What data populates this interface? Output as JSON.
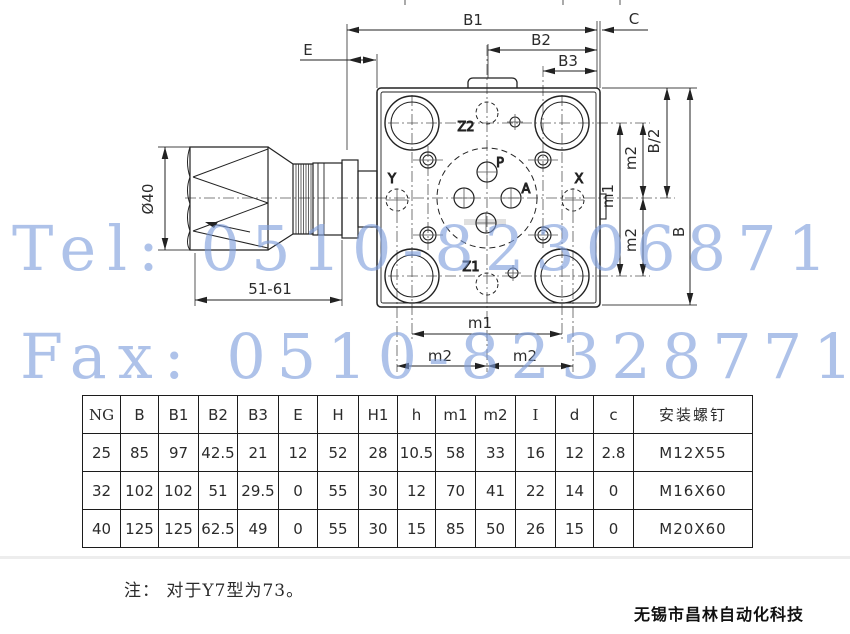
{
  "drawing": {
    "dims": {
      "b1": "B1",
      "b2": "B2",
      "b3": "B3",
      "c": "C",
      "e": "E",
      "dia40": "Ø40",
      "stroke_range": "51-61",
      "m1": "m1",
      "m2": "m2",
      "b_half": "B/2",
      "b": "B"
    },
    "ports": {
      "p": "P",
      "a": "A",
      "x": "X",
      "y": "Y",
      "z1": "Z1",
      "z2": "Z2"
    }
  },
  "watermark": {
    "tel": "Tel: 0510-82306871",
    "fax": "Fax: 0510-82328771",
    "color": "#7d9cdc"
  },
  "table": {
    "headers": [
      "NG",
      "B",
      "B1",
      "B2",
      "B3",
      "E",
      "H",
      "H1",
      "h",
      "m1",
      "m2",
      "I",
      "d",
      "c",
      "安装螺钉"
    ],
    "rows": [
      {
        "ng": "25",
        "values": [
          "85",
          "97",
          "42.5",
          "21",
          "12",
          "52",
          "28",
          "10.5",
          "58",
          "33",
          "16",
          "12",
          "2.8",
          "M12X55"
        ]
      },
      {
        "ng": "32",
        "values": [
          "102",
          "102",
          "51",
          "29.5",
          "0",
          "55",
          "30",
          "12",
          "70",
          "41",
          "22",
          "14",
          "0",
          "M16X60"
        ]
      },
      {
        "ng": "40",
        "values": [
          "125",
          "125",
          "62.5",
          "49",
          "0",
          "55",
          "30",
          "15",
          "85",
          "50",
          "26",
          "15",
          "0",
          "M20X60"
        ]
      }
    ]
  },
  "note": "注： 对于Y7型为73。",
  "company": "无锡市昌林自动化科技"
}
